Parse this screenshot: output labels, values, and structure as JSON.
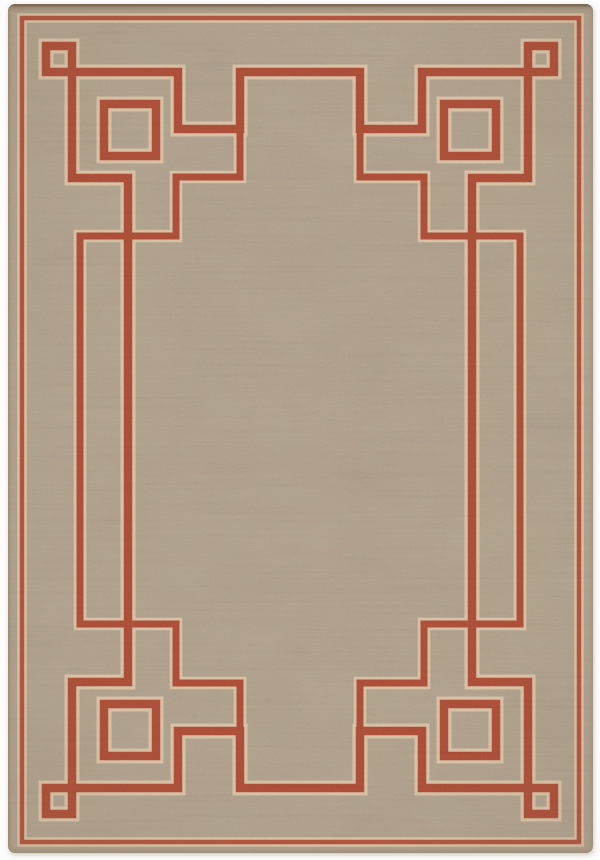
{
  "scene": {
    "type": "product-photo",
    "subject": "flat-weave indoor-outdoor area rug, tan/taupe field with rust-red Greek-key Art Deco border, nested corner squares and center gate motifs",
    "background_color": "#fcfcfc"
  },
  "rug": {
    "x": 8,
    "y": 4,
    "width": 585,
    "height": 849,
    "corner_radius": 7,
    "field_color": "#b2a28c",
    "edge_dark_color": "#6f5f4d",
    "edge_band_color": "#9c8d7b",
    "shadow_color": "#d8d4cd"
  },
  "pattern": {
    "red": "#af4c35",
    "pinstripe_red": "#b4523a",
    "halo": "#dcc4a6",
    "stroke": {
      "main": 8.5,
      "main_halo": 15,
      "thin": 7,
      "thin_halo": 12.5,
      "pin": 4.5,
      "pin_halo": 9.5
    },
    "paths": {
      "pinstripe_rect": "M22,18 H579 V842 H22 Z",
      "main_loop": "M72,72 H178 V129 H240 V72 H360 V129 H422 V72 H528 V178 H472 V682 H528 V788 H422 V731 H360 V788 H240 V731 H178 V788 H72 V682 H128 V178 H72 Z",
      "thin_frame_left": "M240,129 V177 H176 V236 H80 V624 H176 V683 H240 V731",
      "thin_frame_right": "M360,129 V177 H424 V236 H520 V624 H424 V683 H360 V731"
    },
    "small_squares": {
      "size": 26,
      "positions": [
        [
          46,
          46
        ],
        [
          528,
          46
        ],
        [
          46,
          788
        ],
        [
          528,
          788
        ]
      ]
    },
    "medium_squares": {
      "size": 52,
      "positions": [
        [
          104,
          104
        ],
        [
          444,
          104
        ],
        [
          104,
          704
        ],
        [
          444,
          704
        ]
      ]
    }
  }
}
